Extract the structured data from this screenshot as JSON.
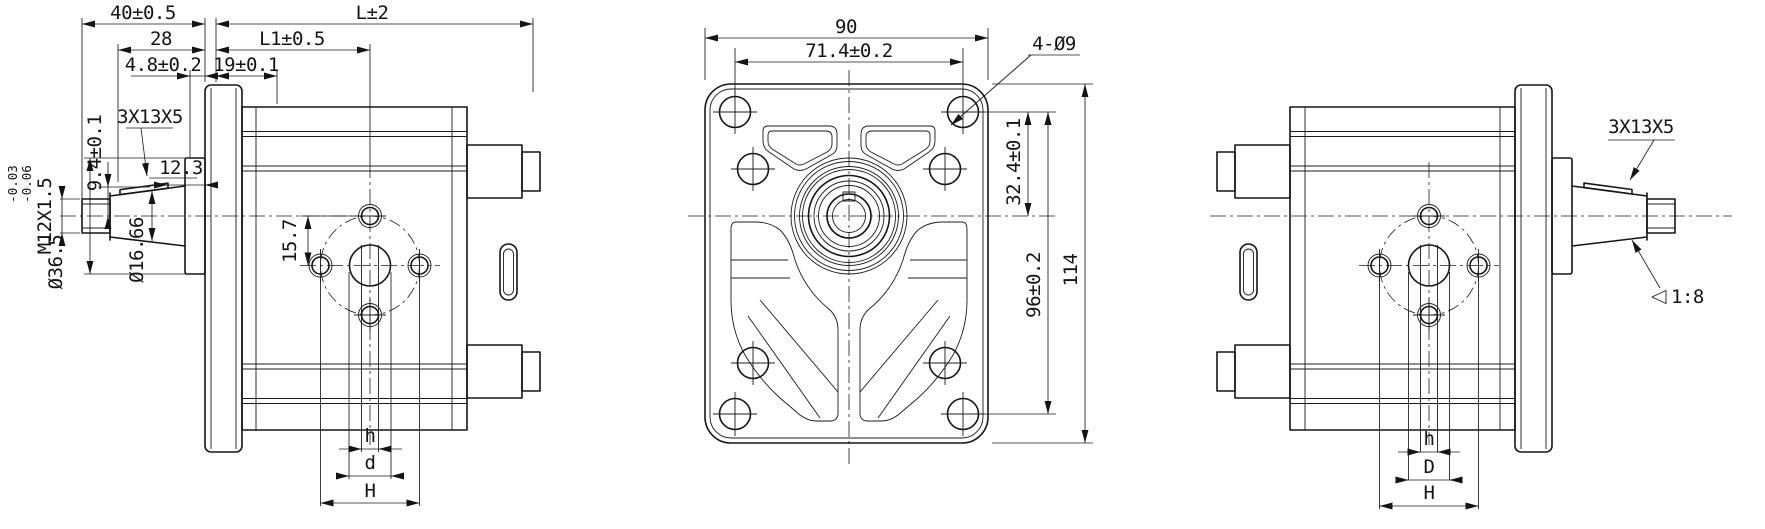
{
  "drawing": {
    "type": "gear-pump-outline-drawing",
    "views": {
      "left": {
        "dims": {
          "len40": "40±0.5",
          "lenL": "L±2",
          "len28": "28",
          "lenL1": "L1±0.5",
          "len48": "4.8±0.2",
          "len19": "19±0.1",
          "key": "3X13X5",
          "h94": "9.4±0.1",
          "len123": "12.3",
          "thread": "M12X1.5",
          "pilot": "Ø36.5",
          "tolUp": "-0.03",
          "tolLo": "-0.06",
          "taperDia": "Ø16.66",
          "off157": "15.7",
          "dimh": "h",
          "dimd": "d",
          "dimH": "H"
        }
      },
      "front": {
        "dims": {
          "w90": "90",
          "bolt714": "71.4±0.2",
          "holes": "4-Ø9",
          "off324": "32.4±0.1",
          "v96": "96±0.2",
          "h114": "114"
        }
      },
      "right": {
        "dims": {
          "key": "3X13X5",
          "taper": "1:8",
          "dimh": "h",
          "dimD": "D",
          "dimH": "H"
        }
      }
    }
  }
}
